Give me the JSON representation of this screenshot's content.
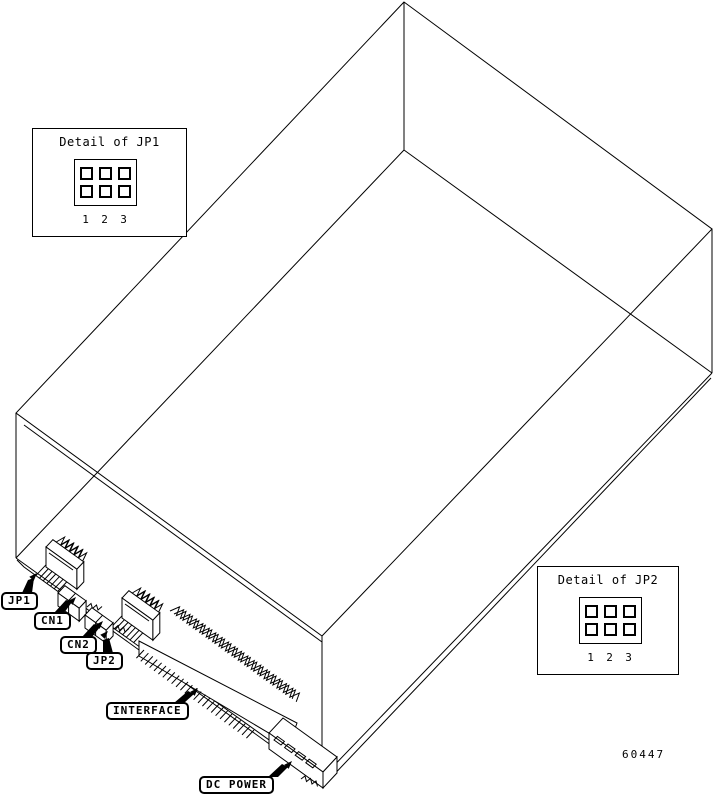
{
  "drawing": {
    "fig_number": "60447",
    "detail_jp1": {
      "title": "Detail of JP1",
      "pins": [
        "1",
        "2",
        "3"
      ]
    },
    "detail_jp2": {
      "title": "Detail of JP2",
      "pins": [
        "1",
        "2",
        "3"
      ]
    },
    "callouts": {
      "jp1": "JP1",
      "cn1": "CN1",
      "cn2": "CN2",
      "jp2": "JP2",
      "interface": "INTERFACE",
      "dc_power": "DC POWER"
    },
    "colors": {
      "line": "#000000",
      "background": "#ffffff"
    }
  }
}
